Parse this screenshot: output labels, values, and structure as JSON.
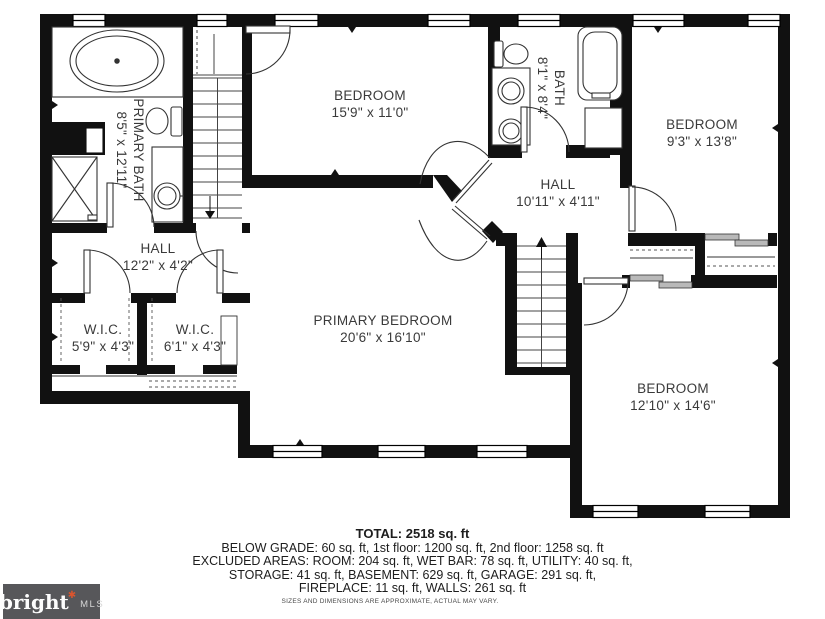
{
  "rooms": {
    "primary_bath": {
      "name": "PRIMARY BATH",
      "dims": "8'5\" x 12'11\""
    },
    "bedroom_top": {
      "name": "BEDROOM",
      "dims": "15'9\" x 11'0\""
    },
    "bath": {
      "name": "BATH",
      "dims": "8'1\" x 8'4\""
    },
    "bedroom_right": {
      "name": "BEDROOM",
      "dims": "9'3\" x 13'8\""
    },
    "hall_upper": {
      "name": "HALL",
      "dims": "10'11\" x 4'11\""
    },
    "hall_left": {
      "name": "HALL",
      "dims": "12'2\" x 4'2\""
    },
    "wic_left": {
      "name": "W.I.C.",
      "dims": "5'9\" x 4'3\""
    },
    "wic_right": {
      "name": "W.I.C.",
      "dims": "6'1\" x 4'3\""
    },
    "primary_bedroom": {
      "name": "PRIMARY BEDROOM",
      "dims": "20'6\" x 16'10\""
    },
    "bedroom_bottom": {
      "name": "BEDROOM",
      "dims": "12'10\" x 14'6\""
    }
  },
  "summary": {
    "total": "TOTAL: 2518 sq. ft",
    "line_below_grade": "BELOW GRADE: 60 sq. ft, 1st floor: 1200 sq. ft, 2nd floor: 1258 sq. ft",
    "line_excluded": "EXCLUDED AREAS: ROOM: 204 sq. ft, WET BAR: 78 sq. ft, UTILITY: 40 sq. ft,",
    "line_storage": "STORAGE: 41 sq. ft, BASEMENT: 629 sq. ft, GARAGE: 291 sq. ft,",
    "line_fireplace": "FIREPLACE: 11 sq. ft, WALLS: 261 sq. ft"
  },
  "disclaimer": "SIZES AND DIMENSIONS ARE APPROXIMATE, ACTUAL MAY VARY.",
  "logo": {
    "brand": "bright",
    "mark": "✱",
    "suffix": "MLS"
  },
  "colors": {
    "wall": "#111111",
    "line": "#333333",
    "label": "#3a3a3a",
    "logo_bg": "#57575a",
    "logo_accent": "#d9552e"
  }
}
